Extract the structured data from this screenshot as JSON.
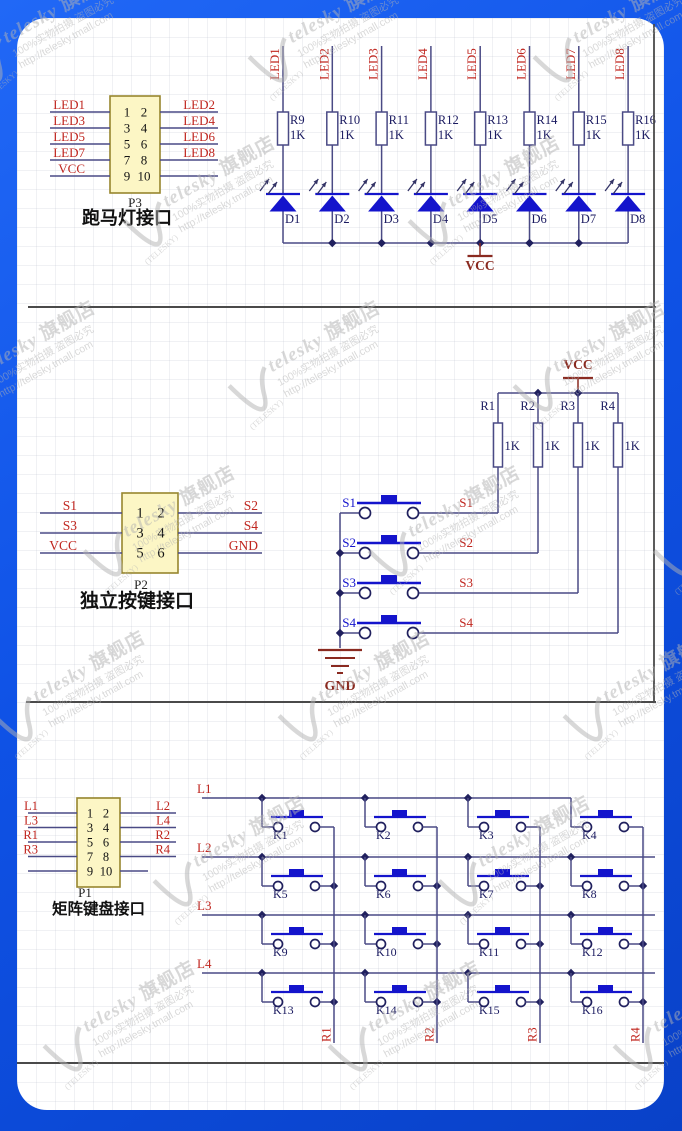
{
  "colors": {
    "frame_blue_light": "#2168f6",
    "frame_blue_dark": "#0941c8",
    "wire": "#4a4a85",
    "part_blue": "#1414cc",
    "net_red": "#c0261f",
    "power_maroon": "#8a2a20",
    "label_navy": "#1a1a60",
    "pin_black": "#141414",
    "dot": "#20205e",
    "arrow": "#333366",
    "connector_fill": "#fcf6c5",
    "connector_border": "#97862e",
    "divider": "#4a4a4a",
    "watermark_gray": "#b3b3b3"
  },
  "watermark": {
    "brand": "telesky",
    "brand_suffix": "旗舰店",
    "line2": "100%实物拍摄 盗图必究",
    "line3": "http://telesky.tmall.com",
    "arc_text": "TELESKY"
  },
  "sections": {
    "led": {
      "connector": {
        "ref": "P3",
        "caption": "跑马灯接口",
        "pin_rows": [
          [
            "1",
            "2"
          ],
          [
            "3",
            "4"
          ],
          [
            "5",
            "6"
          ],
          [
            "7",
            "8"
          ],
          [
            "9",
            "10"
          ]
        ],
        "left_nets": [
          "LED1",
          "LED3",
          "LED5",
          "LED7",
          "VCC"
        ],
        "right_nets": [
          "LED2",
          "LED4",
          "LED6",
          "LED8",
          ""
        ]
      },
      "columns": [
        {
          "net": "LED1",
          "resistor": "R9",
          "value": "1K",
          "diode": "D1"
        },
        {
          "net": "LED2",
          "resistor": "R10",
          "value": "1K",
          "diode": "D2"
        },
        {
          "net": "LED3",
          "resistor": "R11",
          "value": "1K",
          "diode": "D3"
        },
        {
          "net": "LED4",
          "resistor": "R12",
          "value": "1K",
          "diode": "D4"
        },
        {
          "net": "LED5",
          "resistor": "R13",
          "value": "1K",
          "diode": "D5"
        },
        {
          "net": "LED6",
          "resistor": "R14",
          "value": "1K",
          "diode": "D6"
        },
        {
          "net": "LED7",
          "resistor": "R15",
          "value": "1K",
          "diode": "D7"
        },
        {
          "net": "LED8",
          "resistor": "R16",
          "value": "1K",
          "diode": "D8"
        }
      ],
      "power_net": "VCC"
    },
    "keys": {
      "connector": {
        "ref": "P2",
        "caption": "独立按键接口",
        "pin_rows": [
          [
            "1",
            "2"
          ],
          [
            "3",
            "4"
          ],
          [
            "5",
            "6"
          ]
        ],
        "left_nets": [
          "S1",
          "S3",
          "VCC"
        ],
        "right_nets": [
          "S2",
          "S4",
          "GND"
        ]
      },
      "power_net": "VCC",
      "ground_net": "GND",
      "resistors": [
        {
          "name": "R1",
          "value": "1K"
        },
        {
          "name": "R2",
          "value": "1K"
        },
        {
          "name": "R3",
          "value": "1K"
        },
        {
          "name": "R4",
          "value": "1K"
        }
      ],
      "switches": [
        {
          "id": "S1",
          "net": "S1"
        },
        {
          "id": "S2",
          "net": "S2"
        },
        {
          "id": "S3",
          "net": "S3"
        },
        {
          "id": "S4",
          "net": "S4"
        }
      ]
    },
    "matrix": {
      "connector": {
        "ref": "P1",
        "caption": "矩阵键盘接口",
        "pin_rows": [
          [
            "1",
            "2"
          ],
          [
            "3",
            "4"
          ],
          [
            "5",
            "6"
          ],
          [
            "7",
            "8"
          ],
          [
            "9",
            "10"
          ]
        ],
        "left_nets": [
          "L1",
          "L3",
          "R1",
          "R3",
          ""
        ],
        "right_nets": [
          "L2",
          "L4",
          "R2",
          "R4",
          ""
        ]
      },
      "row_nets": [
        "L1",
        "L2",
        "L3",
        "L4"
      ],
      "col_nets": [
        "R1",
        "R2",
        "R3",
        "R4"
      ],
      "keys": [
        [
          "K1",
          "K2",
          "K3",
          "K4"
        ],
        [
          "K5",
          "K6",
          "K7",
          "K8"
        ],
        [
          "K9",
          "K10",
          "K11",
          "K12"
        ],
        [
          "K13",
          "K14",
          "K15",
          "K16"
        ]
      ]
    }
  }
}
